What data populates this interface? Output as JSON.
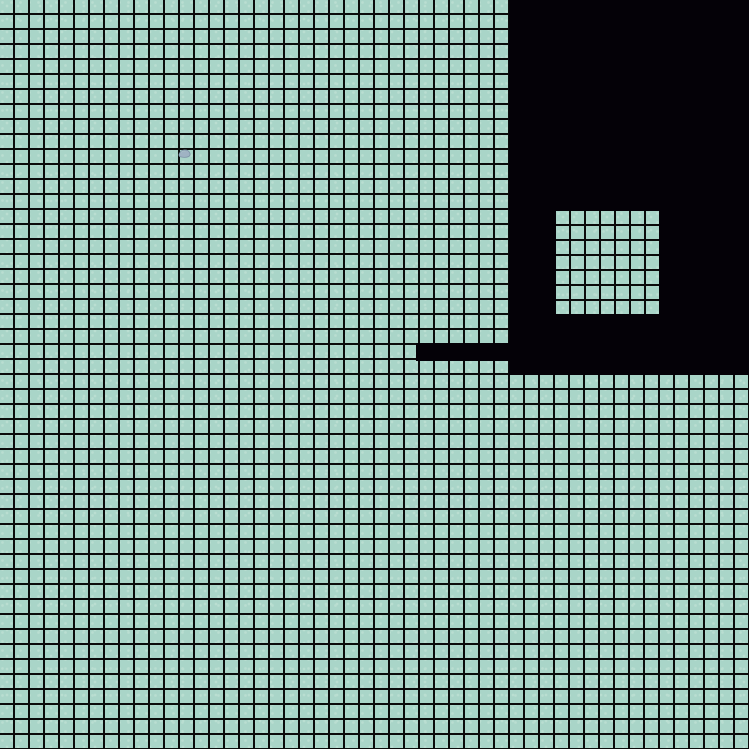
{
  "scene": {
    "name": "tile-map-overworld",
    "viewport": {
      "width": 749,
      "height": 749
    },
    "grid": {
      "cell_size": 15,
      "line_thickness": 2,
      "columns": 50,
      "rows": 50
    },
    "colors": {
      "tile": "#a9d5c8",
      "tile_speckle": "#b9ded1",
      "grid_line": "#0b0b0b",
      "void": "#040107",
      "pebble": "#9fb3c3",
      "pebble_edge": "#7d93a6"
    },
    "regions": {
      "void_block": {
        "x": 509,
        "y": 0,
        "width": 240,
        "height": 375
      },
      "void_bar": {
        "x": 416,
        "y": 343,
        "width": 93,
        "height": 18
      },
      "clearing": {
        "x": 556,
        "y": 211,
        "width": 103,
        "height": 103
      }
    },
    "sprites": {
      "pebble": {
        "x": 178,
        "y": 148,
        "width": 13,
        "height": 10
      }
    }
  }
}
